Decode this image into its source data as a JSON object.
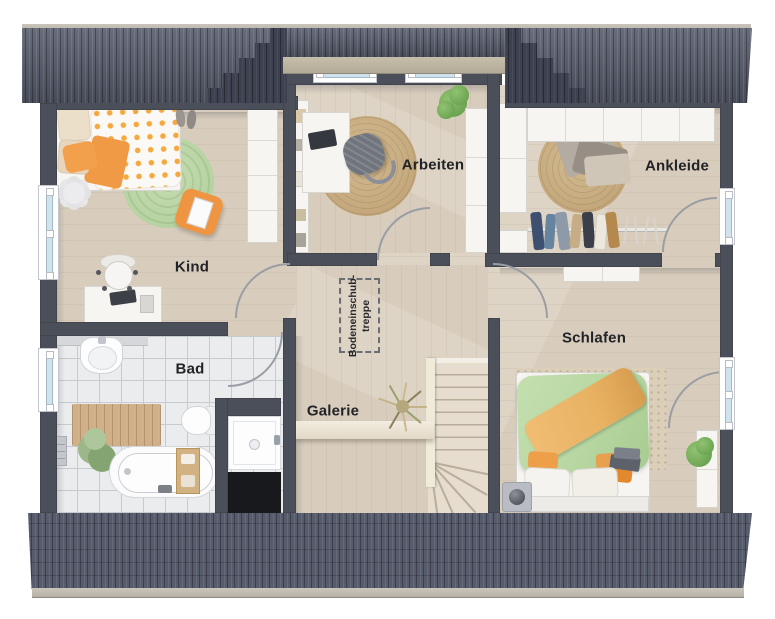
{
  "meta": {
    "type": "floor-plan-rendering",
    "style": "top-down 3D"
  },
  "rooms": {
    "kind": {
      "label": "Kind"
    },
    "bad": {
      "label": "Bad"
    },
    "galerie": {
      "label": "Galerie"
    },
    "arbeiten": {
      "label": "Arbeiten"
    },
    "ankleide": {
      "label": "Ankleide"
    },
    "schlafen": {
      "label": "Schlafen"
    }
  },
  "annotations": {
    "attic_stair": {
      "line1": "Bodeneinschub-",
      "line2": "treppe"
    }
  },
  "colors": {
    "wall": "#4b4f5a",
    "roof": "#575c6c",
    "roof_dark": "#3e4250",
    "eave": "#b6b1a5",
    "dormer_eave": "#b3ab97",
    "wood": "#d8cdbd",
    "wood_light": "#ded4c5",
    "tile": "#eaecee",
    "tile_line": "#c6cad1",
    "rug_green": "#b5d2a0",
    "jute": "#c4a87c",
    "orange": "#f09a45",
    "duvet_green": "#b8d7a2",
    "throw_orange": "#e8b262",
    "arc": "#9a9da3",
    "black_void": "#18191c",
    "white_furn": "#f6f5f2",
    "stair": "#e6ddce",
    "stair_line": "#b9ad9b",
    "glass": "#cfe2ee",
    "text": "#222327"
  }
}
